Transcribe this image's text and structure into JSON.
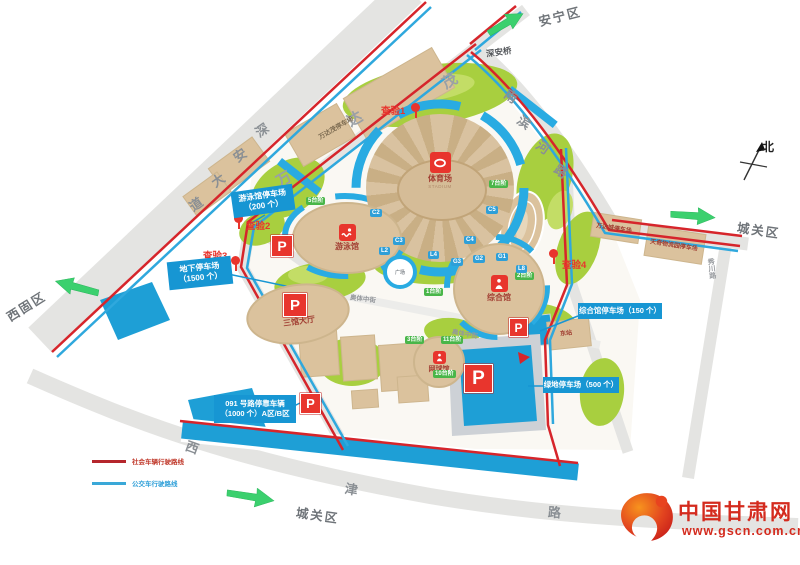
{
  "map": {
    "districts": {
      "anning": "安宁区",
      "chengguan_east": "城关区",
      "chengguan_south": "城关区",
      "xigu": "西固区"
    },
    "roads": {
      "shenan_bridge": "深安桥",
      "shenan_dadao": [
        "深",
        "安",
        "大",
        "道"
      ],
      "nanbinhe": [
        "南",
        "滨",
        "河",
        "路"
      ],
      "xijin": [
        "西",
        "津",
        "路"
      ],
      "xiuchuan": "秀川路",
      "aoti_middle_1": "奥体中街",
      "aoti_middle_2": "奥体中街",
      "wanda_mao": [
        "万",
        "达",
        "茂"
      ]
    },
    "compass_north": "北",
    "checkpoints": {
      "c1": "查验1",
      "c2": "查验2",
      "c3": "查验3",
      "c4": "查验4"
    },
    "venues": {
      "stadium_name": "体育场",
      "stadium_eng": "STADIUM",
      "natatorium": "游泳馆",
      "gymnasium": "综合馆",
      "tennis": "网球馆",
      "three_hall_lobby": "三馆大厅",
      "plaza": "广场",
      "east_station": "东站"
    },
    "parking": {
      "p": "P",
      "natatorium_line1": "游泳馆停车场",
      "natatorium_line2": "（200 个）",
      "underground_line1": "地下停车场",
      "underground_line2": "（1500 个）",
      "gymnasium": "综合馆停车场（150 个）",
      "greenbelt": "绿地停车场（500 个）",
      "road091_line1": "091 号路停靠车辆",
      "road091_line2": "（1000 个）A区/B区",
      "wanda_mao": "万达茂停车场",
      "wanda_city": "万达城停车场",
      "tianqi": "天奇物流园停车场"
    },
    "legend": {
      "red": "社会车辆行驶路线",
      "blue": "公交车行驶路线"
    },
    "gate_tags": [
      {
        "t": "5台阶"
      },
      {
        "t": "7台阶"
      },
      {
        "t": "1台阶"
      },
      {
        "t": "3台阶"
      },
      {
        "t": "11台阶"
      },
      {
        "t": "10台阶"
      },
      {
        "t": "2台阶"
      },
      {
        "t": "C2"
      },
      {
        "t": "C3"
      },
      {
        "t": "C4"
      },
      {
        "t": "C5"
      },
      {
        "t": "L2"
      },
      {
        "t": "L4"
      },
      {
        "t": "L8"
      },
      {
        "t": "G3"
      },
      {
        "t": "G2"
      },
      {
        "t": "G1"
      }
    ],
    "watermark": {
      "site_name": "中国甘肃网",
      "site_url": "www.gscn.com.cn"
    },
    "colors": {
      "route_red": "#d6252b",
      "route_blue": "#2fa8dd",
      "parking_blue": "#1796d3",
      "lawn_green": "#a8cf3f",
      "building_beige": "#dbc29d",
      "arrow_green": "#3bd06e",
      "marker_red": "#e8352d"
    }
  }
}
